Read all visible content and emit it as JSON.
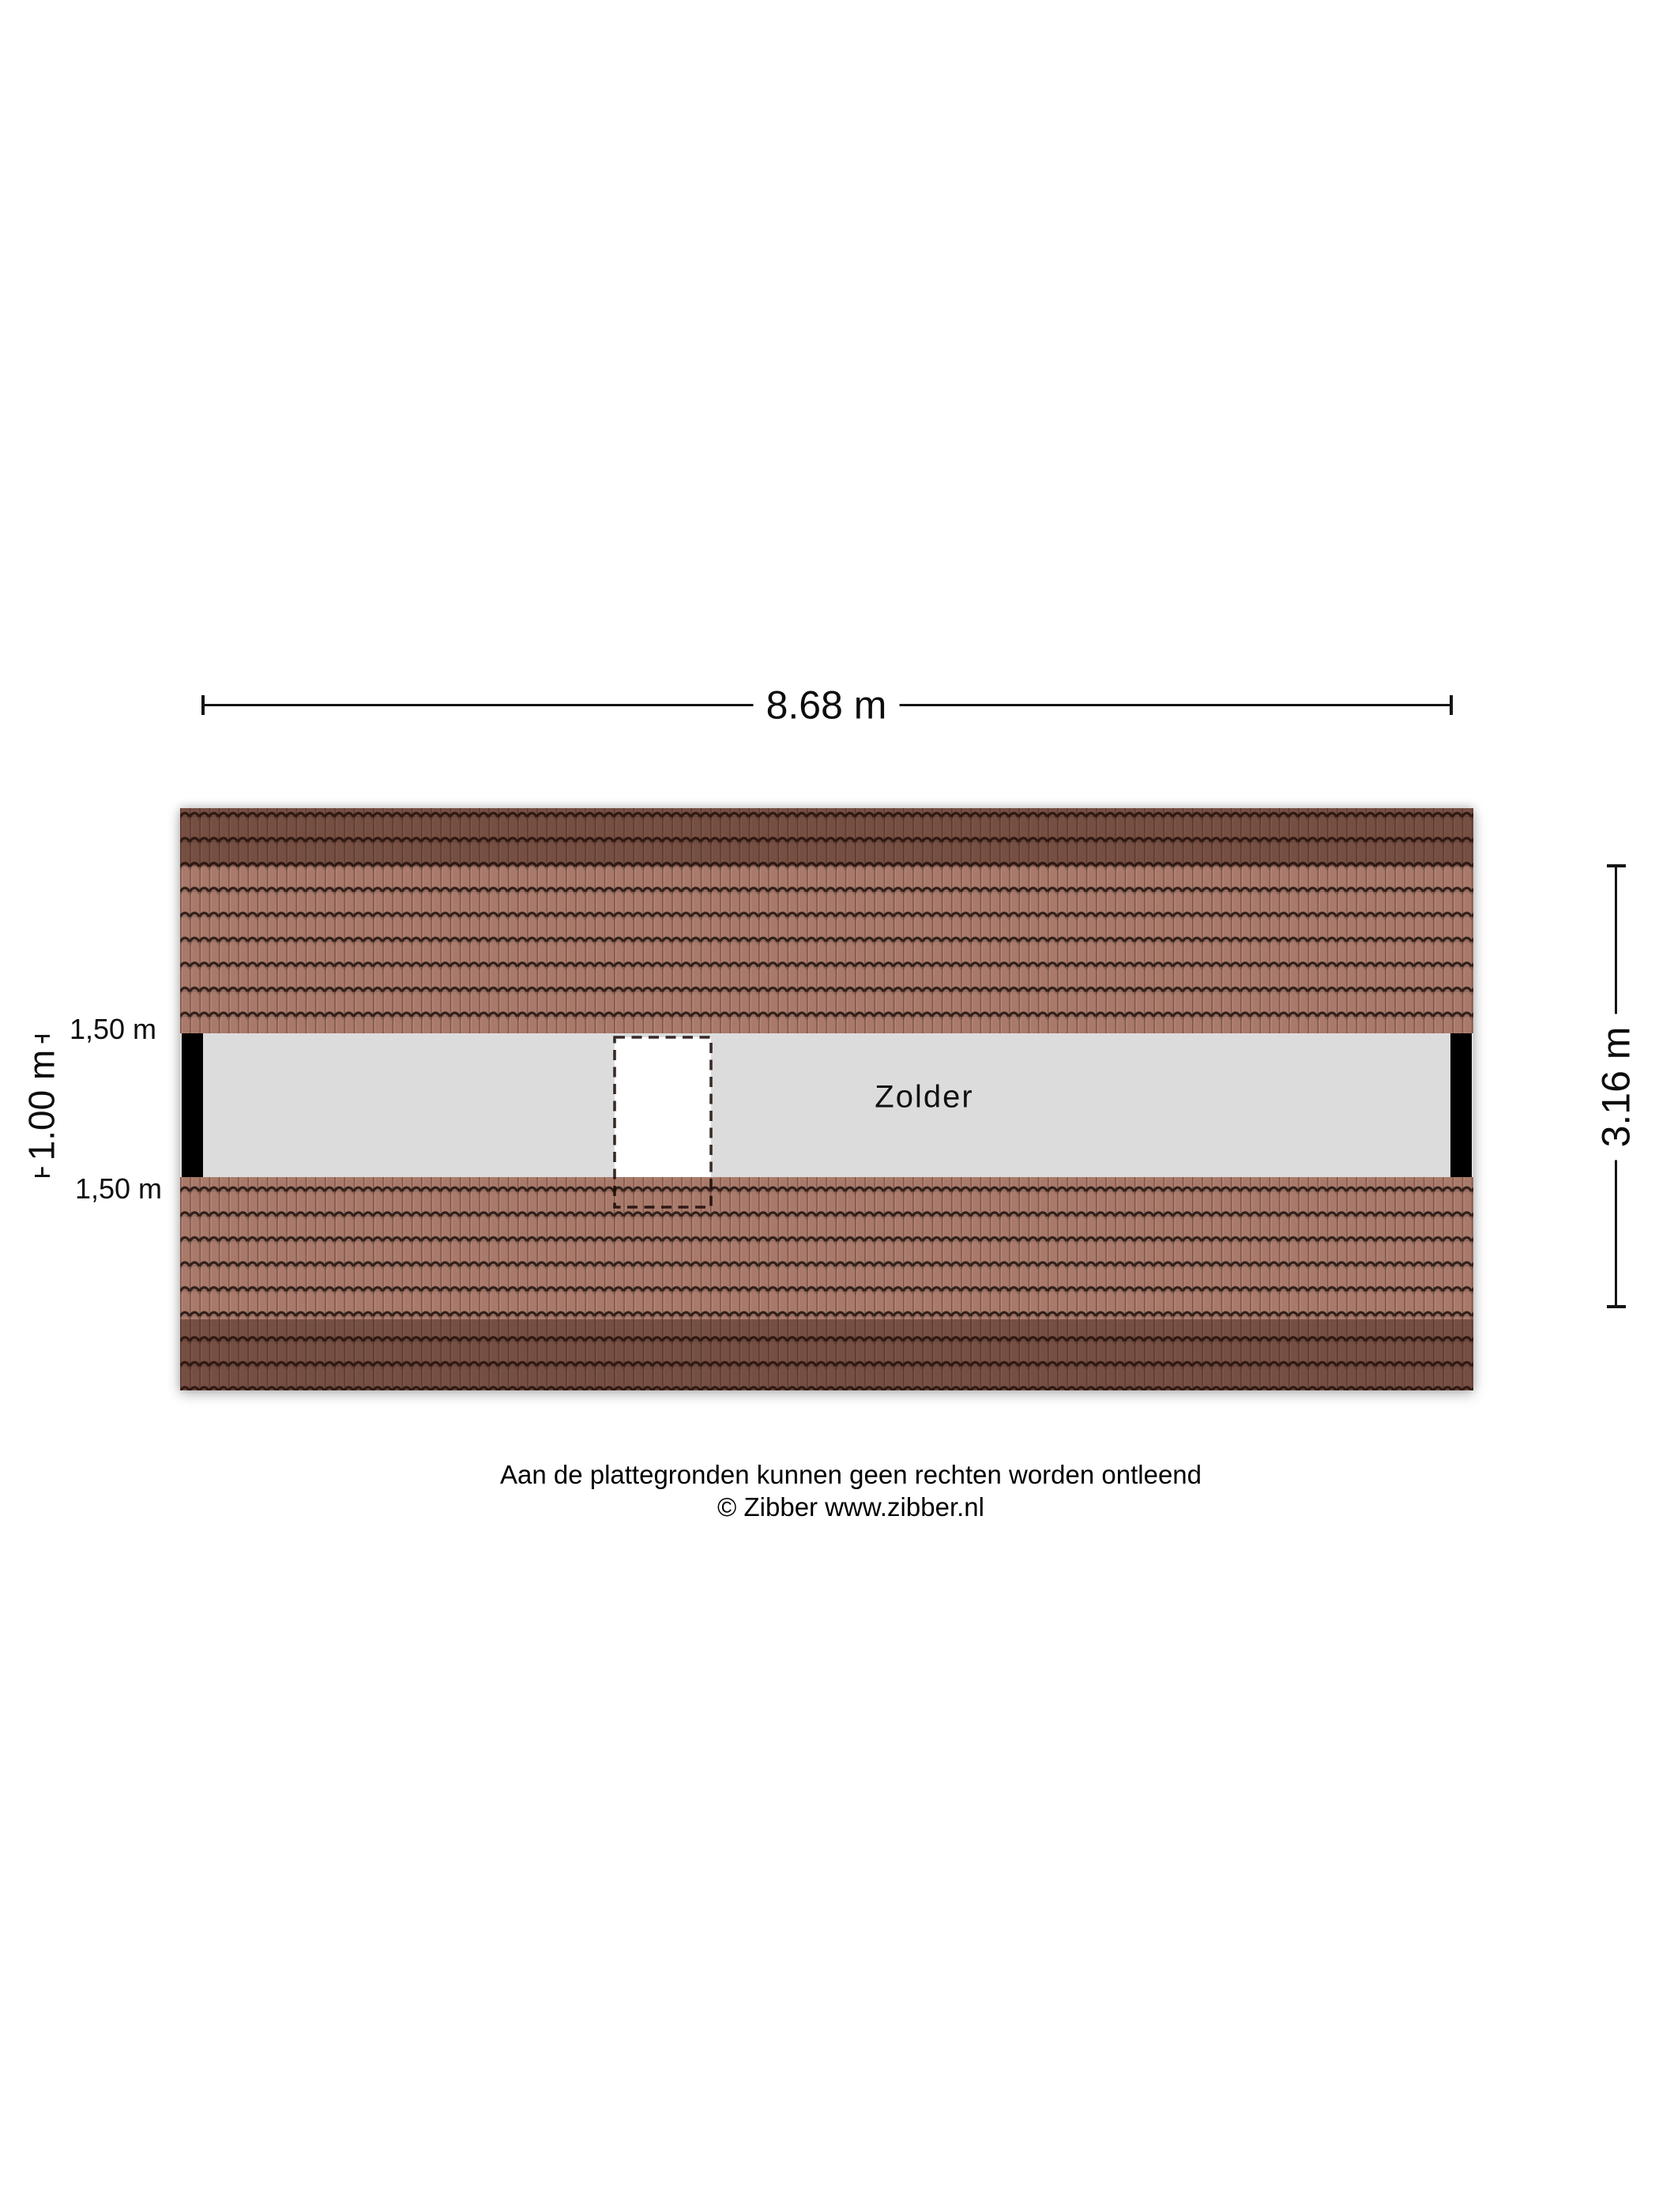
{
  "floorplan": {
    "room_label": "Zolder",
    "width_dimension": {
      "label": "8.68 m"
    },
    "height_dimension": {
      "label": "3.16 m"
    },
    "inner_height_dimension": {
      "label": "1.00 m"
    },
    "clearance_top": {
      "label": "1,50 m"
    },
    "clearance_bottom": {
      "label": "1,50 m"
    },
    "footer": {
      "disclaimer": "Aan de plattegronden kunnen geen rechten worden ontleend",
      "copyright": "© Zibber www.zibber.nl"
    },
    "colors": {
      "tile_base": "#a97a6b",
      "tile_column_shadow": "#7f574a",
      "tile_column_highlight": "#b68877",
      "tile_wave_line": "#32201a",
      "roof_shade_band": "rgba(42,16,8,0.40)",
      "floor_fill": "#dcdcdc",
      "wall_fill": "#000000",
      "opening_fill": "#ffffff",
      "opening_dash": "rgba(25,8,4,0.85)",
      "dimension_line": "#151515",
      "text_color": "#0d0d0d"
    }
  }
}
